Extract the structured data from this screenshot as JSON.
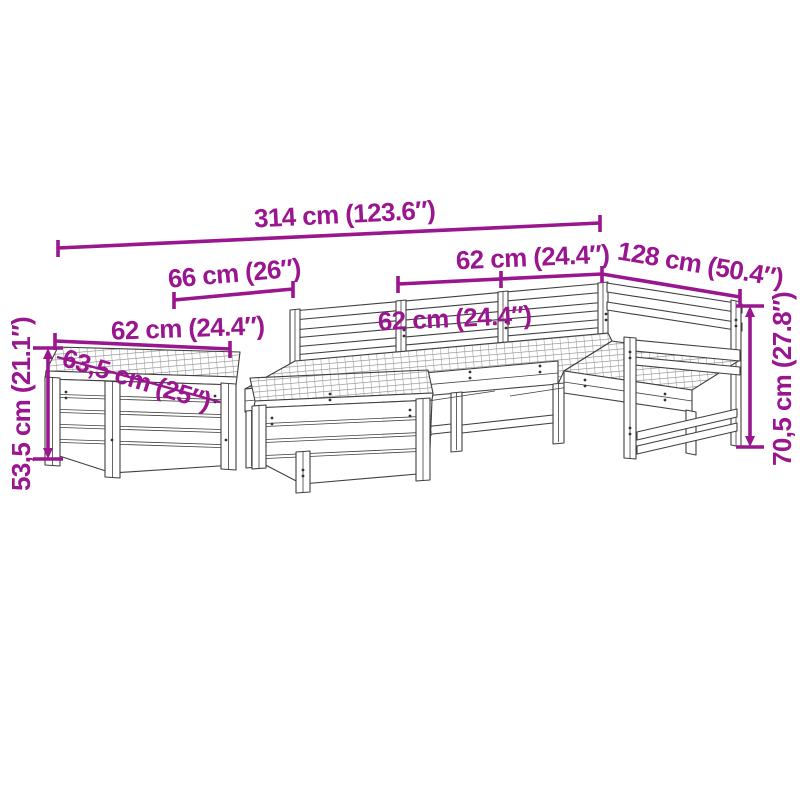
{
  "colors": {
    "dimension_annotation": "#9A168F",
    "drawing_outline": "#3F3F3F",
    "background": "#FFFFFF"
  },
  "dimensions": {
    "total_width": "314 cm (123.6″)",
    "back_left_section_width": "66 cm (26″)",
    "back_mid_section_width": "62 cm (24.4″)",
    "back_right_section_width": "62 cm (24.4″)",
    "right_section_depth": "128 cm (50.4″)",
    "side_table_width": "62 cm (24.4″)",
    "side_table_depth": "63,5 cm (25″)",
    "side_table_height": "53,5 cm (21.1″)",
    "sofa_height": "70,5 cm (27.8″)"
  }
}
